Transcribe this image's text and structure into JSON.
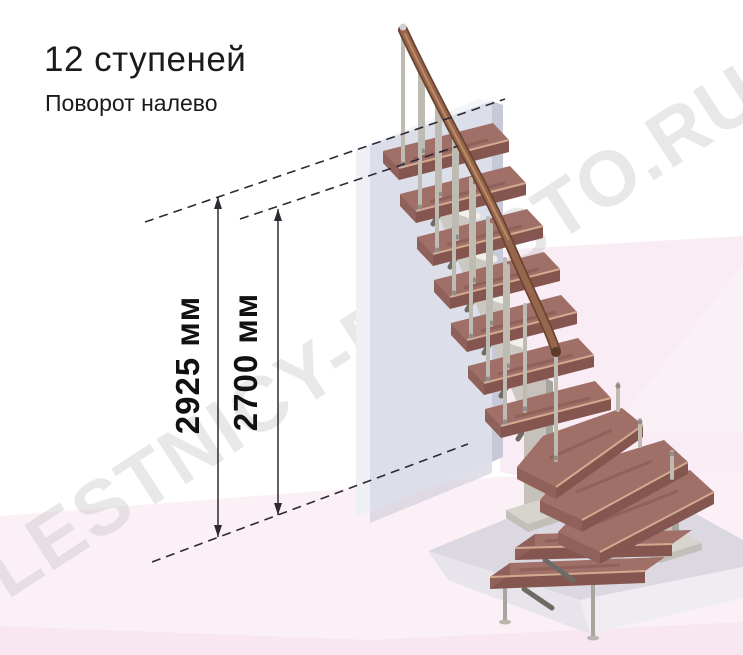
{
  "title": {
    "steps_label": "12 ступеней",
    "turn_label": "Поворот налево"
  },
  "stair": {
    "steps_total": 12,
    "turn_direction": "налево"
  },
  "dimensions": [
    {
      "id": "total-rise",
      "label": "2925 мм"
    },
    {
      "id": "rise-to-top-step",
      "label": "2700 мм"
    }
  ],
  "watermark": "LESTNICY-PROSTO.RU",
  "colors": {
    "wood_top": "#a06f67",
    "wood_front": "#84564f",
    "nose": "#d2aa8f",
    "rail_mid": "#96674c",
    "metal": "#bdbbb2",
    "wall_face": "#dcdfe9",
    "floor_pink": "#fbf0f6",
    "right_bg": "#f9ecf4",
    "pad_top": "#dbd8e2",
    "line_dark": "#2e2a33",
    "text_dark": "#1b1b1b",
    "watermark_gray": "#bdbdbd"
  }
}
